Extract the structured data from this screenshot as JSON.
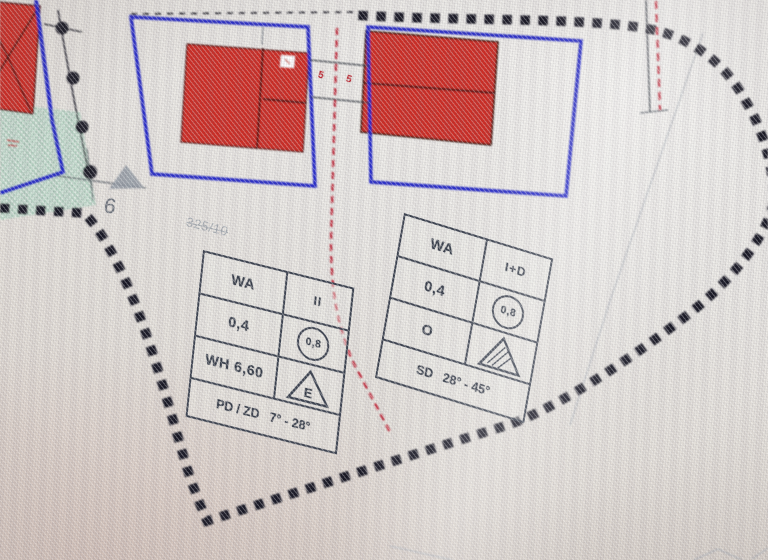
{
  "window": {
    "description": "Bebauungsplan-Ausschnitt (zoning plan detail) photographed from a monitor"
  },
  "labels": {
    "house_number": "6",
    "parcel_number": "325/10",
    "spacing_left": "5",
    "spacing_right": "5"
  },
  "left_schablone": {
    "use": "WA",
    "storeys": "II",
    "grz": "0,4",
    "gfz": "0,8",
    "wall_height": "WH 6,60",
    "bauweise": "E",
    "roof": "PD / ZD   7° - 28°"
  },
  "right_schablone": {
    "use": "WA",
    "storeys": "I+D",
    "grz": "0,4",
    "gfz": "0,8",
    "bauweise": "O",
    "roof": "SD   28° - 45°"
  },
  "colors": {
    "roof_red": "#d42f26",
    "boundary_blue": "#2328c8",
    "plan_boundary_black": "#191924",
    "axis_red_dashed": "#c22838",
    "green_area": "#d5e8dc",
    "table_line": "#3a414e",
    "faint_text": "#99a1a9"
  }
}
